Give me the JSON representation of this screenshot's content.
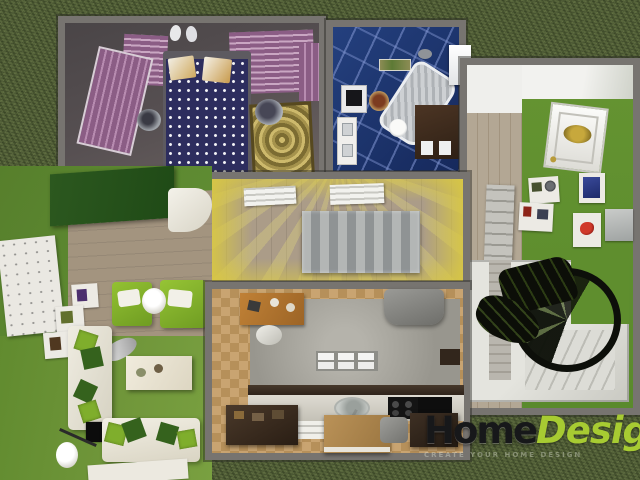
{
  "watermark": {
    "brand_primary": "Home",
    "brand_secondary": "Design",
    "tagline": "CREATE YOUR HOME DESIGN",
    "brand_secondary_color": "#a7cb32"
  },
  "palette": {
    "grass": "#57653b",
    "wall": "#777470",
    "bedroom_floor": "#575052",
    "bed_cover": "#2d2d5e",
    "wardrobe_purple": "#8b5d85",
    "bathroom_tile": "#1c3876",
    "corridor_glow": "#d8c743",
    "living_wall_green": "#5d8a31",
    "living_floor_green": "#6f9639",
    "wood_floor": "#a3947f",
    "kitchen_tile": "#c9a471",
    "counter_dark": "#3a2d23",
    "island_wood": "#b08950",
    "stair_black": "#0d0f0a",
    "logo_green": "#a7cb32"
  },
  "scene": {
    "view": "bird's-eye 3D render of a furnished single-floor home on grass",
    "rooms": [
      {
        "name": "bedroom",
        "furniture": [
          "double-bed with polka-dot cover",
          "purple wardrobe",
          "wall closet panels",
          "ornate rug",
          "round side-stand",
          "slippers"
        ]
      },
      {
        "name": "bathroom",
        "furniture": [
          "bathtub",
          "toilet",
          "washing-machine",
          "sink cabinet",
          "vanity",
          "bath-mat",
          "glass panel"
        ]
      },
      {
        "name": "corridor",
        "furniture": [
          "sideboard",
          "wall shelves"
        ]
      },
      {
        "name": "living-room",
        "furniture": [
          "two green armchairs",
          "round side-table",
          "white sofas with green cushions",
          "coffee-table",
          "tv",
          "shelf-unit",
          "wall panels",
          "floor-lamp",
          "table-lamp",
          "rug",
          "green cabinet"
        ]
      },
      {
        "name": "kitchen",
        "furniture": [
          "counter with sink",
          "stove",
          "kitchen island",
          "desk",
          "armchair",
          "cabinets",
          "radiator"
        ]
      },
      {
        "name": "entry-hall",
        "furniture": [
          "front door",
          "picture frames",
          "wall mirror",
          "clock",
          "shelf"
        ]
      },
      {
        "name": "stairwell",
        "furniture": [
          "spiral staircase"
        ]
      }
    ]
  }
}
